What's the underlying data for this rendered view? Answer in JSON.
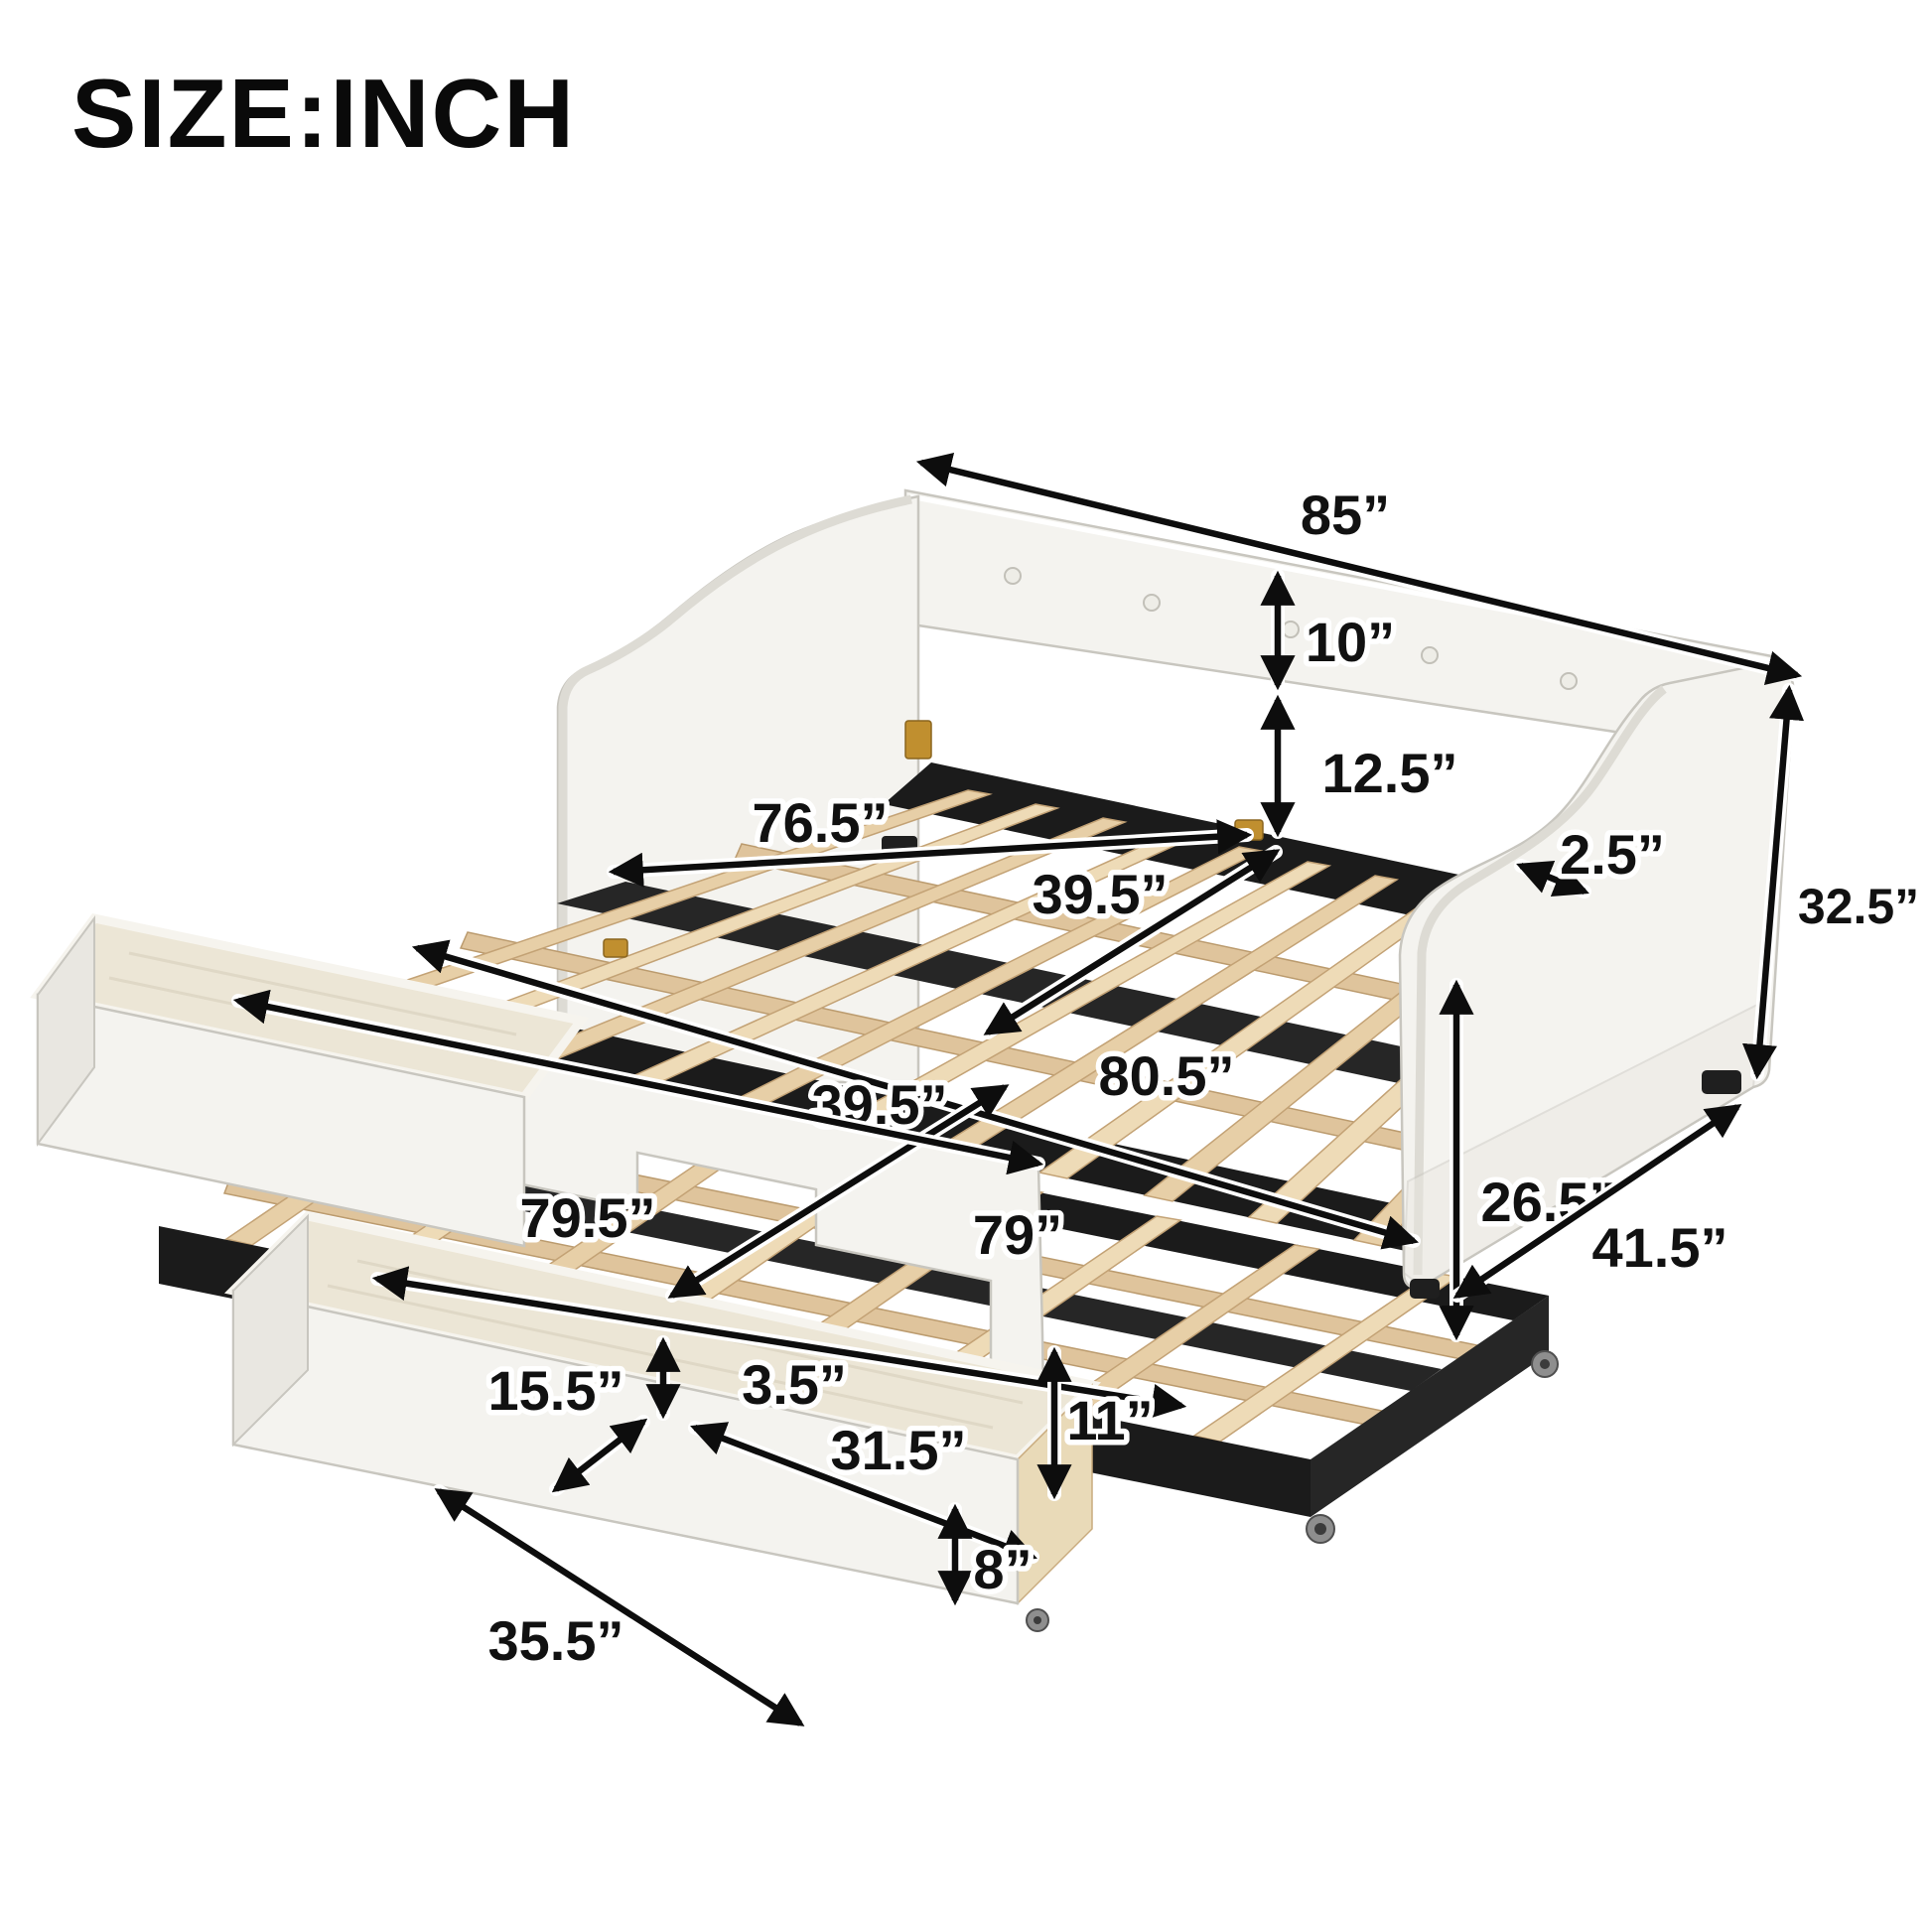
{
  "title": "SIZE:INCH",
  "diagram": {
    "kind": "furniture-dimension-diagram",
    "product": "Upholstered daybed with pull-out trundle and two storage drawers",
    "unit": "inch",
    "colors": {
      "background": "#ffffff",
      "upholstery": "#f4f3ef",
      "frame_black": "#1b1b1b",
      "wood_slat": "#e7cfa7",
      "annotation": "#0d0d0d"
    },
    "dimensions": {
      "overall_length": {
        "name": "overall length (back rail)",
        "inches": 85,
        "display": "85”"
      },
      "backrest_height": {
        "name": "back panel height",
        "inches": 10,
        "display": "10”"
      },
      "back_gap_height": {
        "name": "back panel bottom to slats",
        "inches": 12.5,
        "display": "12.5”"
      },
      "arm_top_thickness": {
        "name": "arm top edge thickness",
        "inches": 2.5,
        "display": "2.5”"
      },
      "overall_height": {
        "name": "overall height",
        "inches": 32.5,
        "display": "32.5”"
      },
      "arm_front_height": {
        "name": "arm / side height",
        "inches": 26.5,
        "display": "26.5”"
      },
      "overall_depth": {
        "name": "overall depth",
        "inches": 41.5,
        "display": "41.5”"
      },
      "inner_length": {
        "name": "inner length between arms",
        "inches": 76.5,
        "display": "76.5”"
      },
      "main_bed_width": {
        "name": "main bed slat width",
        "inches": 39.5,
        "display": "39.5”"
      },
      "extended_length": {
        "name": "extended deck length",
        "inches": 80.5,
        "display": "80.5”"
      },
      "trundle_width": {
        "name": "trundle slat width",
        "inches": 39.5,
        "display": "39.5”"
      },
      "trundle_length": {
        "name": "trundle length",
        "inches": 79,
        "display": "79”"
      },
      "side_rail_length": {
        "name": "front side rail length",
        "inches": 79.5,
        "display": "79.5”"
      },
      "drawer_depth": {
        "name": "drawer depth",
        "inches": 15.5,
        "display": "15.5”"
      },
      "drawer_gap": {
        "name": "gap between drawers",
        "inches": 3.5,
        "display": "3.5”"
      },
      "drawer_inner_length": {
        "name": "drawer inner length",
        "inches": 31.5,
        "display": "31.5”"
      },
      "trundle_frame_height": {
        "name": "trundle frame height",
        "inches": 11,
        "display": "11”"
      },
      "drawer_outer_length": {
        "name": "drawer outer length",
        "inches": 35.5,
        "display": "35.5”"
      },
      "drawer_height": {
        "name": "drawer height",
        "inches": 8,
        "display": "8”"
      }
    }
  }
}
